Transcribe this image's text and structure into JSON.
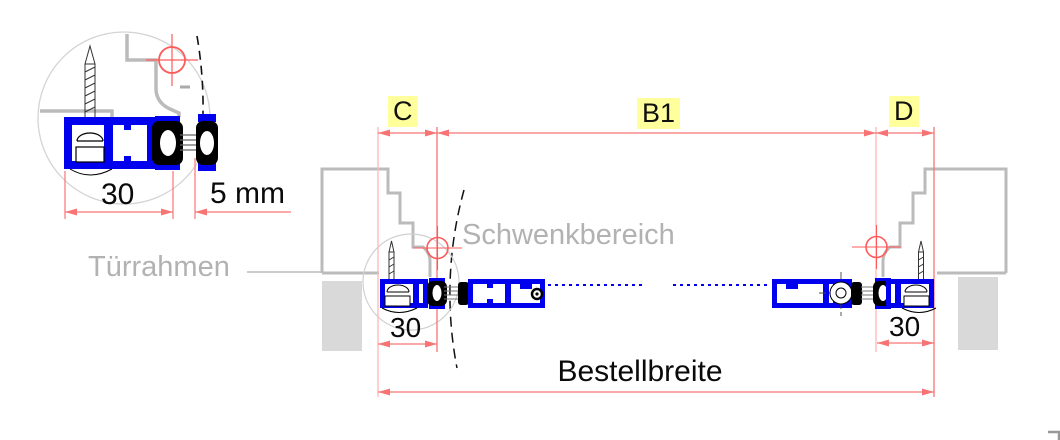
{
  "drawing": {
    "section_labels": {
      "c": "C",
      "b1": "B1",
      "d": "D"
    },
    "dimensions": {
      "detail_width": "30",
      "detail_gap": "5 mm",
      "left_width": "30",
      "right_width": "30",
      "order_width_label": "Bestellbreite"
    },
    "annotations": {
      "door_frame": "Türrahmen",
      "swing_area": "Schwenkbereich"
    },
    "colors": {
      "profile_blue": "#0000ee",
      "dimension_red": "#f87474",
      "extension_red_light": "#ffb6b6",
      "crosshair_red": "#ff5a5a",
      "label_highlight": "#ffff9c",
      "frame_gray": "#bbbbbb",
      "wall_fill_gray": "#d9d9d9",
      "annotation_text_gray": "#b2b2b2"
    }
  }
}
